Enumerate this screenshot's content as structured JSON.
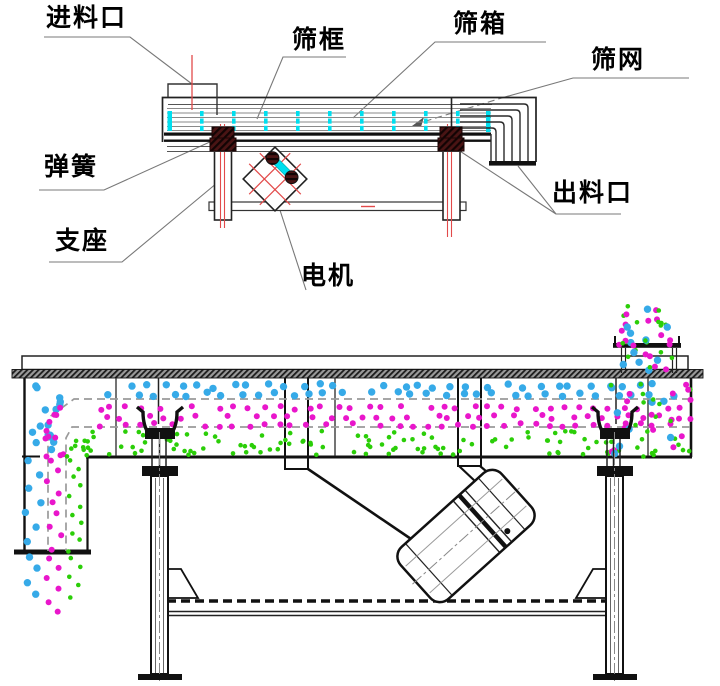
{
  "labels": {
    "feed_inlet": "进料口",
    "screen_frame": "筛框",
    "screen_box": "筛箱",
    "screen_mesh": "筛网",
    "spring": "弹簧",
    "support": "支座",
    "motor": "电机",
    "discharge_outlet": "出料口"
  },
  "colors": {
    "particle_large_blue": "#36AAE8",
    "particle_medium_magenta": "#E916CB",
    "particle_fine_green": "#2BCE08",
    "mesh_tick_cyan": "#00DFEF",
    "centerline_red": "#E24A4A",
    "spring_block_maroon": "#3C1010",
    "line_black": "#151515",
    "leader_gray": "#787878"
  }
}
